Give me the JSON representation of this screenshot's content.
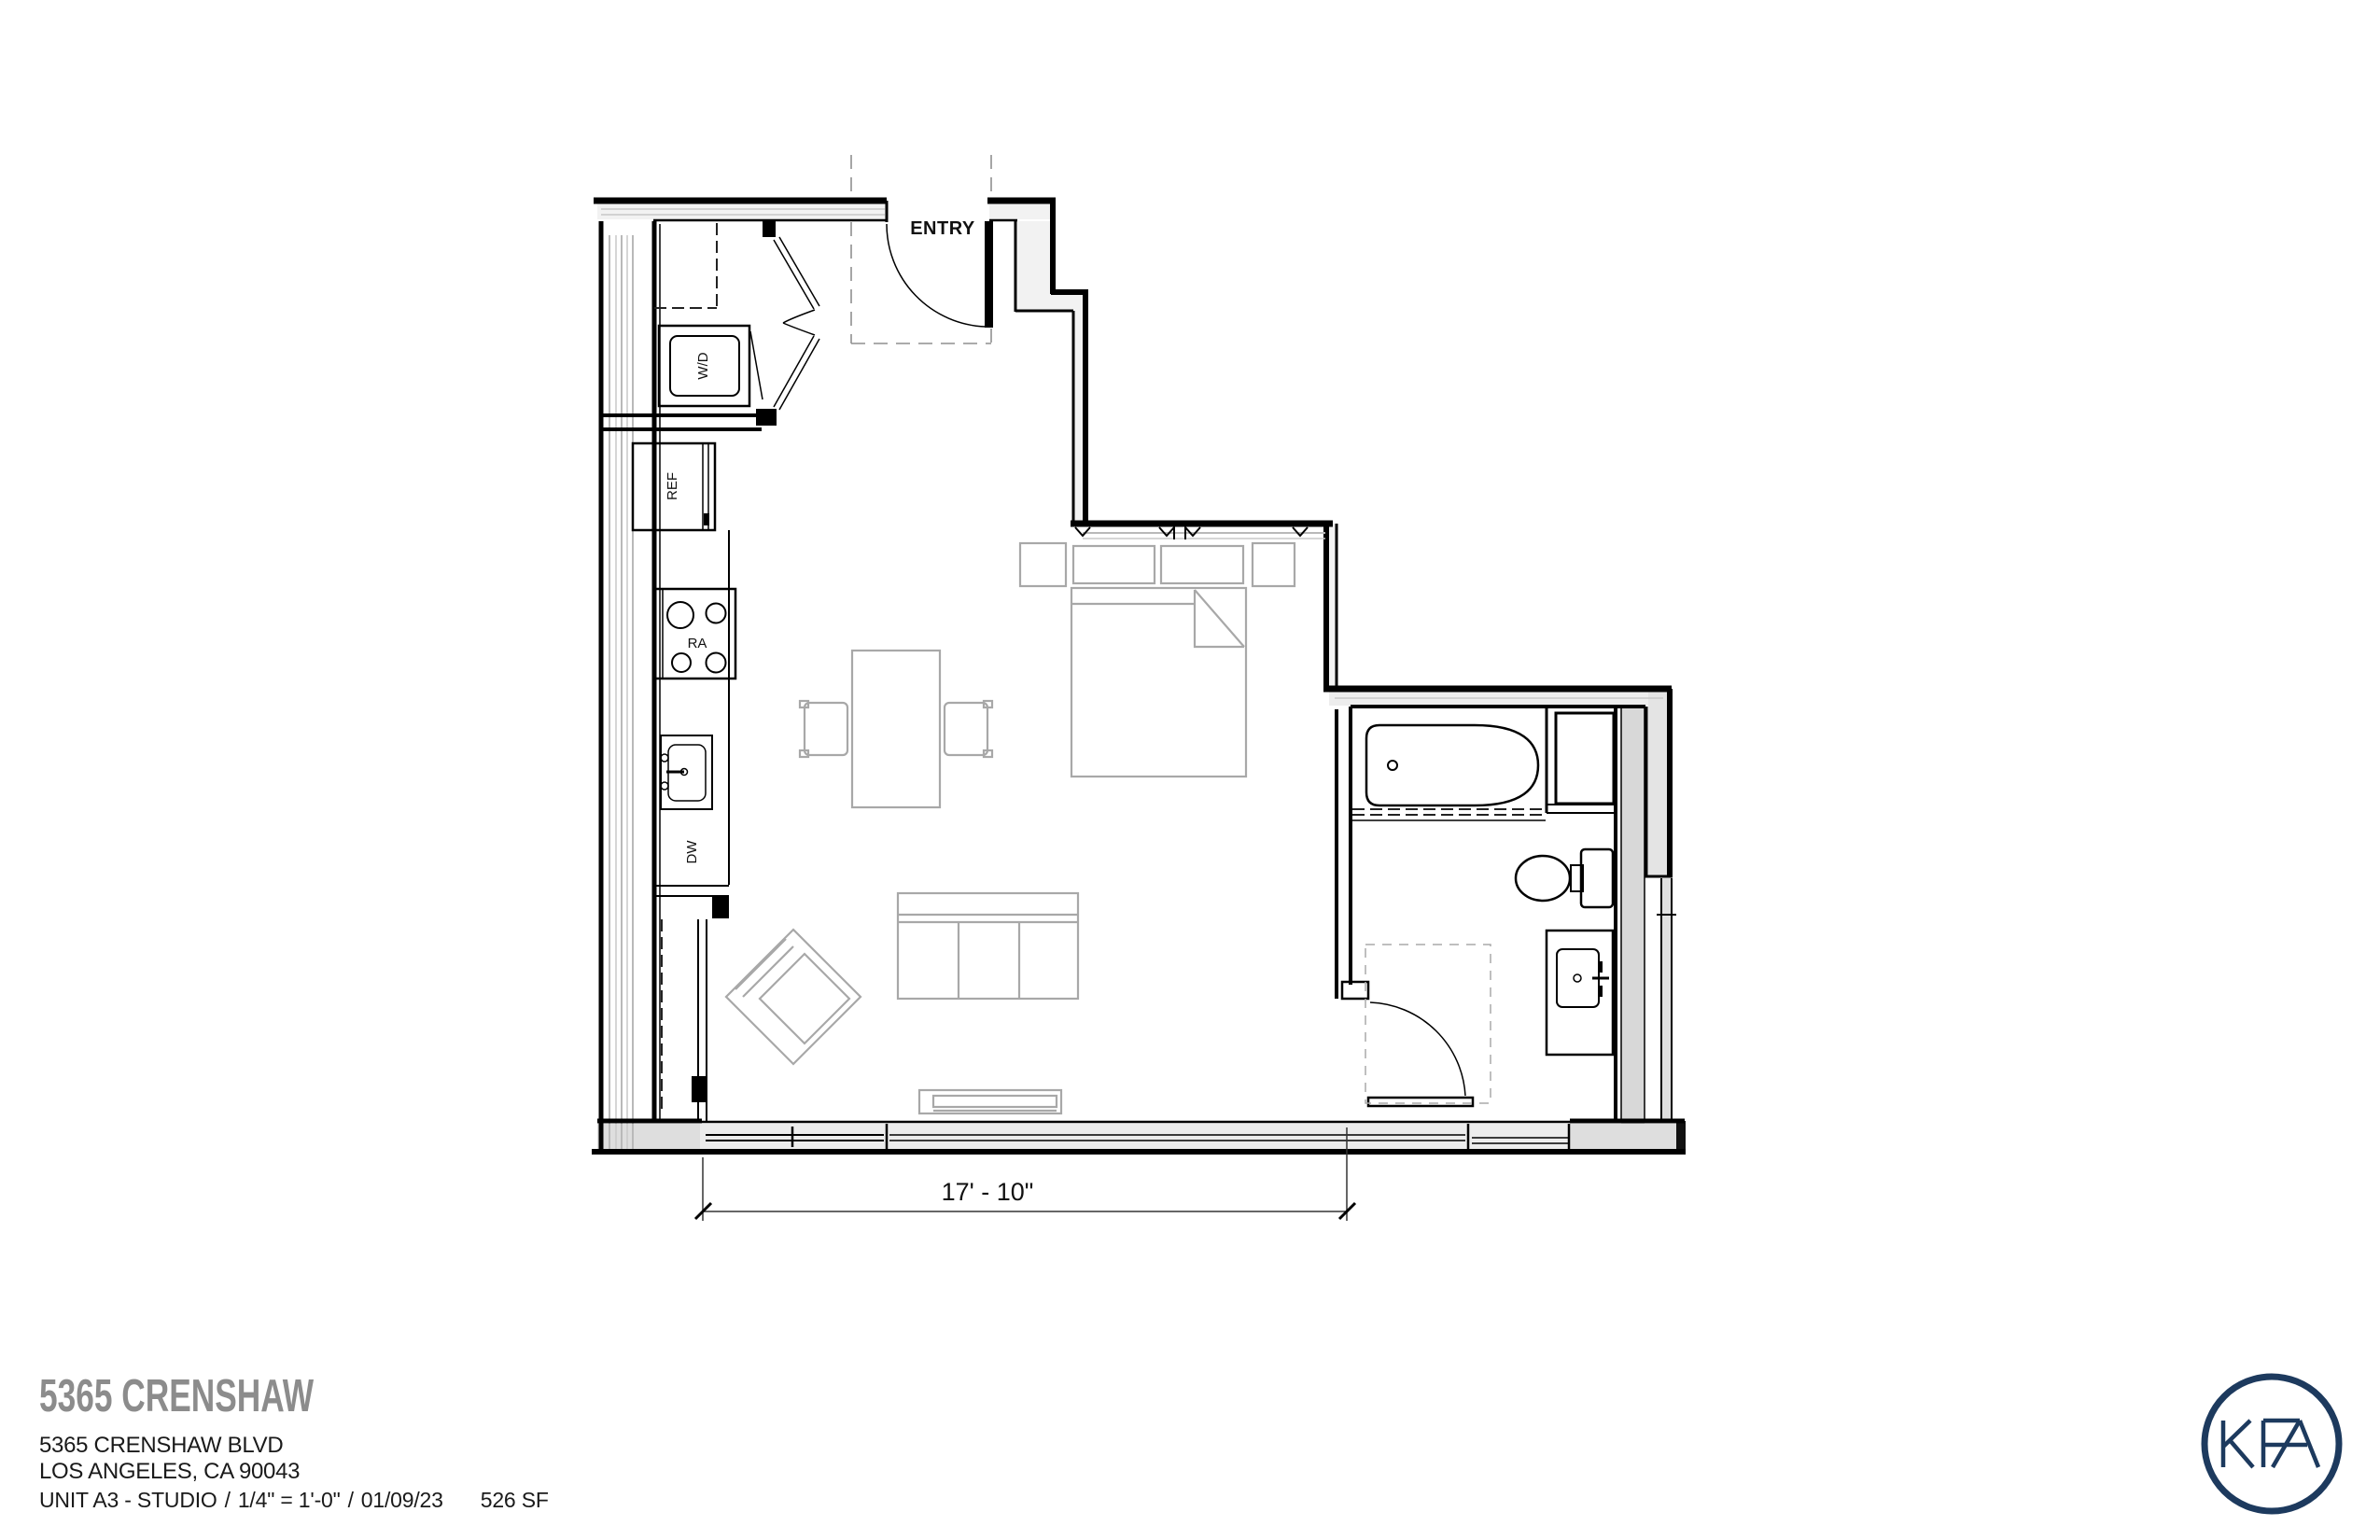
{
  "plan": {
    "labels": {
      "entry": "ENTRY",
      "washer_dryer": "W/D",
      "refrigerator": "REF",
      "range": "RA",
      "dishwasher": "DW"
    },
    "dimension": {
      "width_label": "17' - 10\""
    }
  },
  "title_block": {
    "project_name": "5365 CRENSHAW",
    "address_line1": "5365 CRENSHAW BLVD",
    "address_line2": "LOS ANGELES, CA 90043",
    "unit_label": "UNIT A3 - STUDIO",
    "separator1": "/",
    "scale_label": "1/4\" = 1'-0\"",
    "separator2": "/",
    "date_label": "01/09/23",
    "area_label": "526 SF"
  },
  "logo": {
    "text": "KFA",
    "color": "#1d3a5e"
  },
  "colors": {
    "wall_line": "#000000",
    "furniture_line": "#a8a8a8",
    "title_gray": "#8c8c8c",
    "body_text": "#1a1a1a",
    "dash_line": "#999999"
  }
}
